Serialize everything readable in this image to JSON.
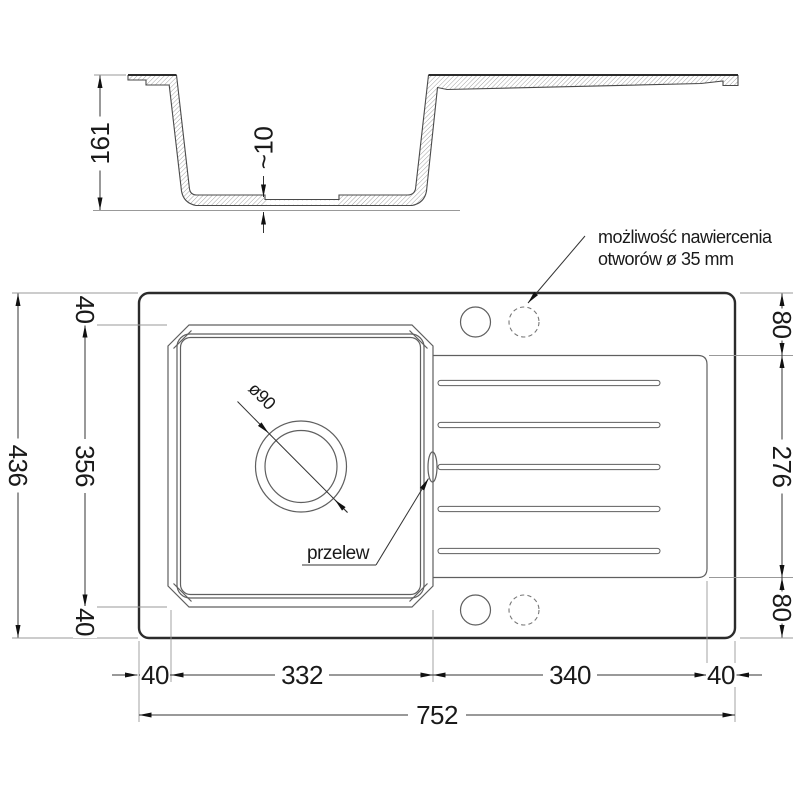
{
  "section": {
    "depth": "161",
    "bottom_thickness": "~10"
  },
  "plan": {
    "left": {
      "total": "436",
      "top_margin": "40",
      "bowl_height": "356",
      "bottom_margin": "40"
    },
    "right": {
      "top_margin": "80",
      "drainer_height": "276",
      "bottom_margin": "80"
    },
    "bottom": {
      "left_margin": "40",
      "bowl_width": "332",
      "drainer_width": "340",
      "right_margin": "40",
      "total": "752"
    },
    "drain": {
      "label": "ø90"
    },
    "overflow": {
      "label": "przelew"
    },
    "tap_holes_note": {
      "line1": "możliwość nawiercenia",
      "line2": "otworów ø 35 mm"
    }
  },
  "colors": {
    "outline_strong": "#2b2b2b",
    "outline": "#5f5f5f",
    "dimension_line": "#333333",
    "extension_line": "#999999",
    "hatch": "#9a9a9a",
    "text": "#1a1a1a",
    "background": "#ffffff"
  }
}
